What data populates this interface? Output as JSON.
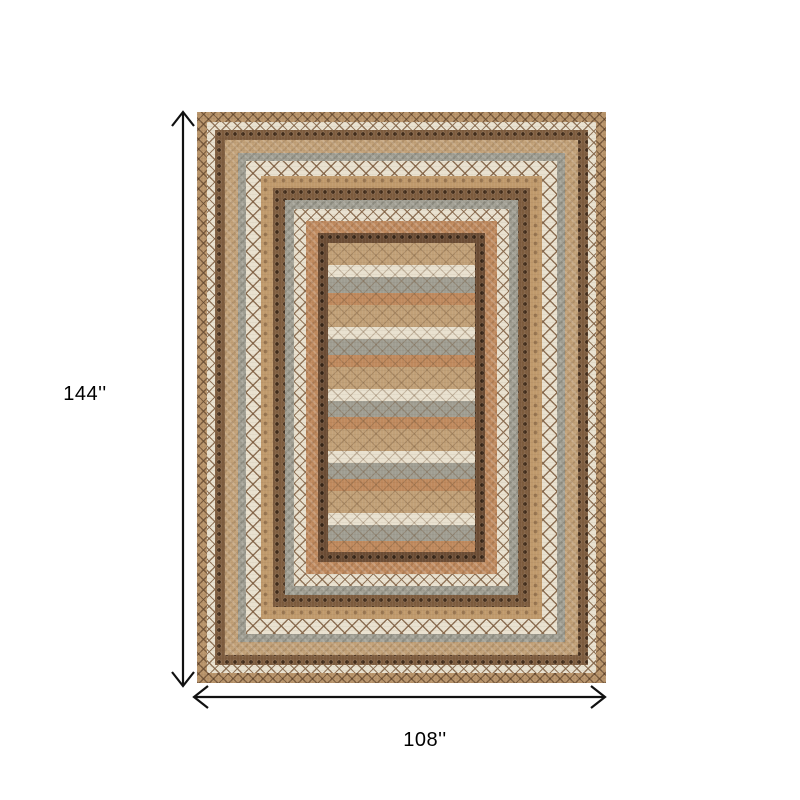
{
  "diagram": {
    "type": "product-dimension-diagram",
    "subject": "rectangular braided area rug with concentric patterned borders and striped center field",
    "height_label": "144''",
    "width_label": "108''",
    "arrow_color": "#111111",
    "background_color": "#ffffff"
  },
  "rug": {
    "colors": {
      "tan": "#c2a178",
      "cream": "#e9e1cf",
      "brown": "#7d5c3e",
      "dark_brown": "#6b4c34",
      "gray": "#a09e92",
      "orange": "#c08a5e",
      "outer_tan": "#b8946a"
    }
  }
}
